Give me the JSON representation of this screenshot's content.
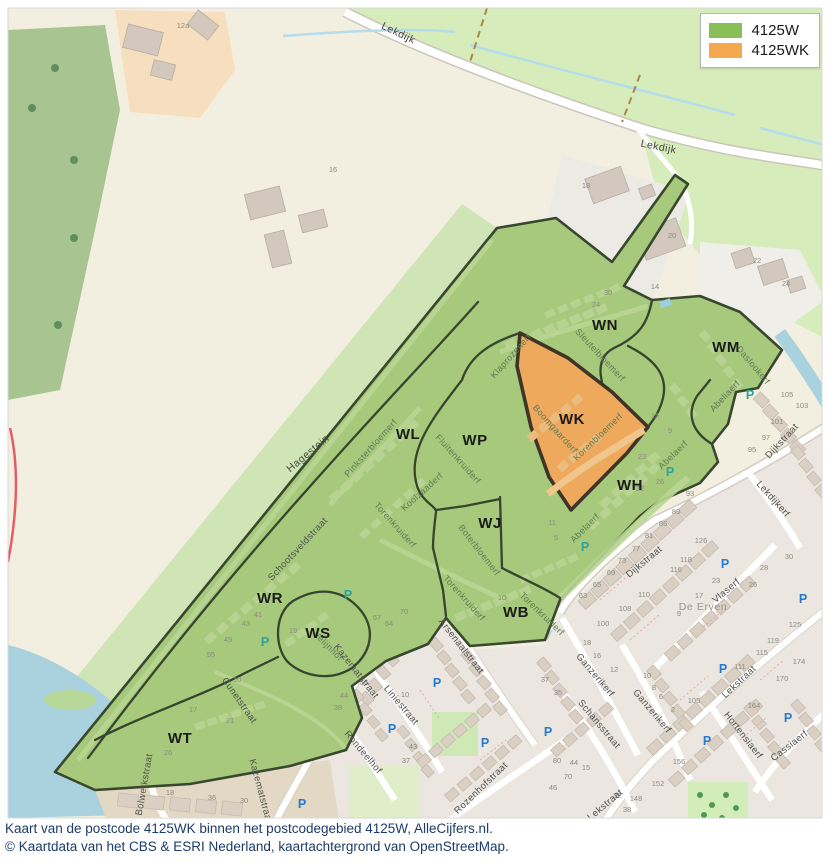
{
  "legend": {
    "items": [
      {
        "label": "4125W",
        "color": "#88c057"
      },
      {
        "label": "4125WK",
        "color": "#f5a94e"
      }
    ]
  },
  "caption": {
    "line1": "Kaart van de postcode 4125WK binnen het postcodegebied 4125W, AlleCijfers.nl.",
    "line2": "© Kaartdata van het CBS & ESRI Nederland, kaartachtergrond van OpenStreetMap."
  },
  "map": {
    "parking_glyph": "P",
    "region_labels": [
      {
        "t": "WN",
        "x": 605,
        "y": 330
      },
      {
        "t": "WM",
        "x": 726,
        "y": 352
      },
      {
        "t": "WK",
        "x": 572,
        "y": 424
      },
      {
        "t": "WL",
        "x": 408,
        "y": 439
      },
      {
        "t": "WP",
        "x": 475,
        "y": 445
      },
      {
        "t": "WJ",
        "x": 490,
        "y": 528
      },
      {
        "t": "WH",
        "x": 630,
        "y": 490
      },
      {
        "t": "WR",
        "x": 270,
        "y": 603
      },
      {
        "t": "WS",
        "x": 318,
        "y": 638
      },
      {
        "t": "WB",
        "x": 516,
        "y": 617
      },
      {
        "t": "WT",
        "x": 180,
        "y": 743
      }
    ],
    "road_labels": [
      {
        "t": "Lekdijk",
        "x": 397,
        "y": 36,
        "r": 26
      },
      {
        "t": "Lekdijk",
        "x": 658,
        "y": 150,
        "r": 11
      },
      {
        "t": "Hagestein",
        "x": 310,
        "y": 456,
        "r": -40
      },
      {
        "t": "Waard",
        "x": 772,
        "y": 64,
        "r": 0,
        "c": "waard"
      }
    ],
    "green_streets": [
      {
        "t": "Sleutelbloemerf",
        "x": 598,
        "y": 357,
        "r": 47
      },
      {
        "t": "Klaprozenerf",
        "x": 513,
        "y": 358,
        "r": -48
      },
      {
        "t": "Pinksterbloemerf",
        "x": 373,
        "y": 450,
        "r": -48
      },
      {
        "t": "Fluitenkruiderf",
        "x": 456,
        "y": 461,
        "r": 48
      },
      {
        "t": "Koolzaaderf",
        "x": 424,
        "y": 494,
        "r": -42
      },
      {
        "t": "Torenkruiderf",
        "x": 393,
        "y": 527,
        "r": 48
      },
      {
        "t": "Torenkruiderf",
        "x": 462,
        "y": 600,
        "r": 48
      },
      {
        "t": "Torenkruiderf",
        "x": 540,
        "y": 616,
        "r": 44
      },
      {
        "t": "Boterbloemerf",
        "x": 477,
        "y": 552,
        "r": 52
      },
      {
        "t": "Boomgaarderf",
        "x": 553,
        "y": 431,
        "r": 48
      },
      {
        "t": "Korenbloemerf",
        "x": 600,
        "y": 439,
        "r": -44
      },
      {
        "t": "Abelaerf",
        "x": 587,
        "y": 530,
        "r": -45
      },
      {
        "t": "Abelaerf",
        "x": 675,
        "y": 457,
        "r": -44
      },
      {
        "t": "Abeliaerf",
        "x": 727,
        "y": 398,
        "r": -47
      },
      {
        "t": "Daslookerf",
        "x": 751,
        "y": 367,
        "r": 50
      },
      {
        "t": "Velijnhof",
        "x": 326,
        "y": 648,
        "r": 45
      }
    ],
    "urban_streets": [
      {
        "t": "Schootsveldstraat",
        "x": 300,
        "y": 551,
        "r": -47
      },
      {
        "t": "Kazematstraat",
        "x": 354,
        "y": 673,
        "r": 52
      },
      {
        "t": "Kazematstraat",
        "x": 258,
        "y": 792,
        "r": 75
      },
      {
        "t": "Arsenaalstraat",
        "x": 459,
        "y": 648,
        "r": 52
      },
      {
        "t": "Liniestraat",
        "x": 399,
        "y": 707,
        "r": 50
      },
      {
        "t": "Rondeelhof",
        "x": 361,
        "y": 754,
        "r": 50
      },
      {
        "t": "Rozenhofstraat",
        "x": 483,
        "y": 790,
        "r": -44
      },
      {
        "t": "Schansstraat",
        "x": 597,
        "y": 726,
        "r": 50
      },
      {
        "t": "Ganzerikerf",
        "x": 593,
        "y": 677,
        "r": 50
      },
      {
        "t": "Ganzerikerf",
        "x": 650,
        "y": 713,
        "r": 50
      },
      {
        "t": "Dijkstraat",
        "x": 646,
        "y": 564,
        "r": -40
      },
      {
        "t": "Dijkstraat",
        "x": 784,
        "y": 443,
        "r": -47
      },
      {
        "t": "Lekdijkerf",
        "x": 771,
        "y": 501,
        "r": 48
      },
      {
        "t": "Vlaserf",
        "x": 728,
        "y": 593,
        "r": -40
      },
      {
        "t": "Lekstraat",
        "x": 741,
        "y": 684,
        "r": -43
      },
      {
        "t": "Lekstraat",
        "x": 607,
        "y": 807,
        "r": -40
      },
      {
        "t": "Hortensiaerf",
        "x": 741,
        "y": 737,
        "r": 52
      },
      {
        "t": "Cassiaerf",
        "x": 791,
        "y": 748,
        "r": -38
      },
      {
        "t": "Bolwerkstraat",
        "x": 147,
        "y": 785,
        "r": -80
      },
      {
        "t": "Cunetstraat",
        "x": 237,
        "y": 702,
        "r": 55
      },
      {
        "t": "De Erven",
        "x": 703,
        "y": 610,
        "r": 0,
        "c": "place"
      }
    ],
    "house_numbers": [
      {
        "t": "12a",
        "x": 183,
        "y": 28
      },
      {
        "t": "16",
        "x": 333,
        "y": 172
      },
      {
        "t": "18",
        "x": 586,
        "y": 188
      },
      {
        "t": "20",
        "x": 672,
        "y": 238
      },
      {
        "t": "22",
        "x": 757,
        "y": 263
      },
      {
        "t": "24",
        "x": 786,
        "y": 286
      },
      {
        "t": "105",
        "x": 787,
        "y": 397
      },
      {
        "t": "103",
        "x": 802,
        "y": 408
      },
      {
        "t": "101",
        "x": 777,
        "y": 424
      },
      {
        "t": "97",
        "x": 766,
        "y": 440
      },
      {
        "t": "95",
        "x": 752,
        "y": 452
      },
      {
        "t": "93",
        "x": 690,
        "y": 496
      },
      {
        "t": "89",
        "x": 676,
        "y": 514
      },
      {
        "t": "85",
        "x": 663,
        "y": 526
      },
      {
        "t": "81",
        "x": 649,
        "y": 538
      },
      {
        "t": "77",
        "x": 636,
        "y": 551
      },
      {
        "t": "73",
        "x": 622,
        "y": 563
      },
      {
        "t": "69",
        "x": 611,
        "y": 575
      },
      {
        "t": "65",
        "x": 597,
        "y": 587
      },
      {
        "t": "63",
        "x": 583,
        "y": 598
      },
      {
        "t": "126",
        "x": 701,
        "y": 543
      },
      {
        "t": "118",
        "x": 686,
        "y": 562
      },
      {
        "t": "116",
        "x": 676,
        "y": 572
      },
      {
        "t": "110",
        "x": 644,
        "y": 597
      },
      {
        "t": "108",
        "x": 625,
        "y": 611
      },
      {
        "t": "100",
        "x": 603,
        "y": 626
      },
      {
        "t": "23",
        "x": 716,
        "y": 583
      },
      {
        "t": "17",
        "x": 699,
        "y": 598
      },
      {
        "t": "9",
        "x": 679,
        "y": 616
      },
      {
        "t": "30",
        "x": 789,
        "y": 559
      },
      {
        "t": "28",
        "x": 764,
        "y": 570
      },
      {
        "t": "26",
        "x": 753,
        "y": 587
      },
      {
        "t": "125",
        "x": 795,
        "y": 627
      },
      {
        "t": "119",
        "x": 773,
        "y": 643
      },
      {
        "t": "115",
        "x": 762,
        "y": 655
      },
      {
        "t": "111",
        "x": 740,
        "y": 669
      },
      {
        "t": "174",
        "x": 799,
        "y": 664
      },
      {
        "t": "170",
        "x": 782,
        "y": 681
      },
      {
        "t": "164",
        "x": 754,
        "y": 708
      },
      {
        "t": "156",
        "x": 679,
        "y": 764
      },
      {
        "t": "152",
        "x": 658,
        "y": 786
      },
      {
        "t": "148",
        "x": 636,
        "y": 801
      },
      {
        "t": "105",
        "x": 694,
        "y": 703
      },
      {
        "t": "18",
        "x": 587,
        "y": 645
      },
      {
        "t": "16",
        "x": 597,
        "y": 658
      },
      {
        "t": "12",
        "x": 614,
        "y": 672
      },
      {
        "t": "10",
        "x": 647,
        "y": 678
      },
      {
        "t": "8",
        "x": 654,
        "y": 690
      },
      {
        "t": "6",
        "x": 661,
        "y": 699
      },
      {
        "t": "2",
        "x": 673,
        "y": 712
      },
      {
        "t": "37",
        "x": 545,
        "y": 682
      },
      {
        "t": "35",
        "x": 558,
        "y": 695
      },
      {
        "t": "70",
        "x": 404,
        "y": 614
      },
      {
        "t": "64",
        "x": 389,
        "y": 626
      },
      {
        "t": "56",
        "x": 364,
        "y": 685
      },
      {
        "t": "44",
        "x": 344,
        "y": 698
      },
      {
        "t": "38",
        "x": 338,
        "y": 710
      },
      {
        "t": "10",
        "x": 405,
        "y": 697
      },
      {
        "t": "80",
        "x": 557,
        "y": 763
      },
      {
        "t": "44",
        "x": 574,
        "y": 765
      },
      {
        "t": "70",
        "x": 568,
        "y": 779
      },
      {
        "t": "46",
        "x": 553,
        "y": 790
      },
      {
        "t": "32",
        "x": 617,
        "y": 798
      },
      {
        "t": "38",
        "x": 627,
        "y": 812
      },
      {
        "t": "43",
        "x": 413,
        "y": 749
      },
      {
        "t": "37",
        "x": 406,
        "y": 763
      },
      {
        "t": "15",
        "x": 586,
        "y": 770
      },
      {
        "t": "30",
        "x": 608,
        "y": 295
      },
      {
        "t": "24",
        "x": 596,
        "y": 307
      },
      {
        "t": "14",
        "x": 655,
        "y": 289
      },
      {
        "t": "23",
        "x": 642,
        "y": 459
      },
      {
        "t": "22",
        "x": 640,
        "y": 491
      },
      {
        "t": "26",
        "x": 660,
        "y": 484
      },
      {
        "t": "15",
        "x": 655,
        "y": 418
      },
      {
        "t": "9",
        "x": 670,
        "y": 433
      },
      {
        "t": "10",
        "x": 237,
        "y": 682
      },
      {
        "t": "17",
        "x": 193,
        "y": 712
      },
      {
        "t": "21",
        "x": 230,
        "y": 723
      },
      {
        "t": "26",
        "x": 168,
        "y": 755
      },
      {
        "t": "36",
        "x": 212,
        "y": 800
      },
      {
        "t": "30",
        "x": 244,
        "y": 803
      },
      {
        "t": "18",
        "x": 170,
        "y": 795
      },
      {
        "t": "19",
        "x": 293,
        "y": 633
      },
      {
        "t": "41",
        "x": 258,
        "y": 617
      },
      {
        "t": "43",
        "x": 246,
        "y": 626
      },
      {
        "t": "49",
        "x": 228,
        "y": 642
      },
      {
        "t": "55",
        "x": 211,
        "y": 657
      },
      {
        "t": "67",
        "x": 377,
        "y": 620
      },
      {
        "t": "10",
        "x": 502,
        "y": 600
      },
      {
        "t": "5",
        "x": 556,
        "y": 540
      },
      {
        "t": "11",
        "x": 552,
        "y": 525
      }
    ],
    "parking_blue": [
      {
        "x": 437,
        "y": 687
      },
      {
        "x": 392,
        "y": 733
      },
      {
        "x": 485,
        "y": 747
      },
      {
        "x": 548,
        "y": 736
      },
      {
        "x": 725,
        "y": 568
      },
      {
        "x": 803,
        "y": 603
      },
      {
        "x": 723,
        "y": 673
      },
      {
        "x": 788,
        "y": 722
      },
      {
        "x": 302,
        "y": 808
      },
      {
        "x": 707,
        "y": 745
      }
    ],
    "parking_teal": [
      {
        "x": 348,
        "y": 599
      },
      {
        "x": 265,
        "y": 646
      },
      {
        "x": 585,
        "y": 551
      },
      {
        "x": 670,
        "y": 476
      },
      {
        "x": 750,
        "y": 399
      }
    ]
  }
}
